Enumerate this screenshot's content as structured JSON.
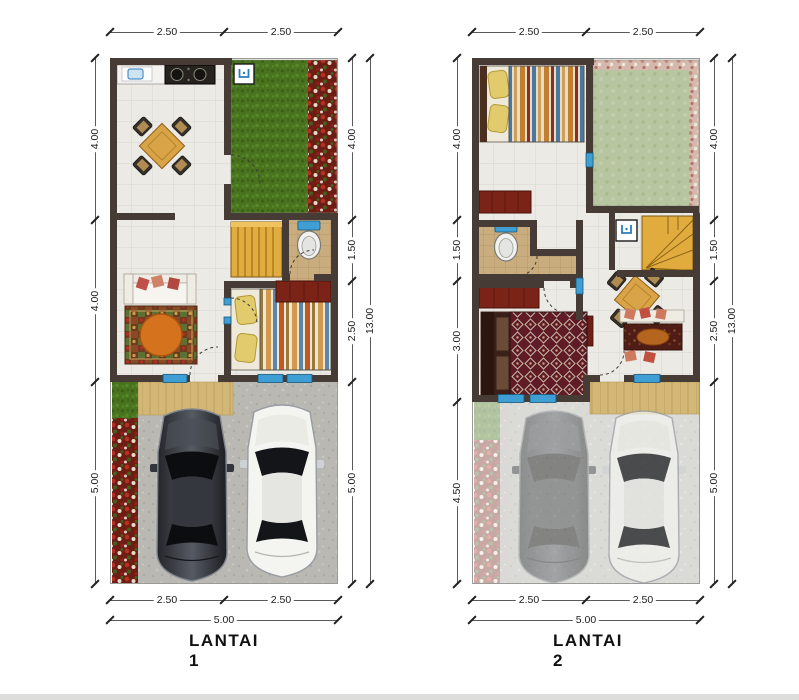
{
  "plans": [
    {
      "label": "LANTAI 1",
      "dims": {
        "top": [
          "2.50",
          "2.50"
        ],
        "bottom": [
          "2.50",
          "2.50"
        ],
        "bottom_total": "5.00",
        "left": [
          "4.00",
          "4.00",
          "5.00"
        ],
        "right": [
          "4.00",
          "1.50",
          "2.50",
          "5.00"
        ],
        "right_total": "13.00"
      }
    },
    {
      "label": "LANTAI 2",
      "dims": {
        "top": [
          "2.50",
          "2.50"
        ],
        "bottom": [
          "2.50",
          "2.50"
        ],
        "bottom_total": "5.00",
        "left": [
          "4.00",
          "1.50",
          "3.00",
          "4.50"
        ],
        "right": [
          "4.00",
          "1.50",
          "2.50",
          "5.00"
        ],
        "right_total": "13.00"
      }
    }
  ],
  "colors": {
    "wall": "#463c35",
    "tile_floor": "#eceae5",
    "bathroom_tile": "#c9ad7e",
    "grass": "#49731f",
    "roof_garden": "#b7c6a0",
    "flower_red": "#6d1d14",
    "stairs_yellow": "#e2ab3e",
    "water_blue": "#3f9fd4",
    "terrace_tan": "#d2b777",
    "furniture_maroon": "#7b2317",
    "concrete": "#b9b8b3"
  },
  "icons": {
    "sink": "sink-icon",
    "stove": "stove-icon",
    "toilet": "toilet-icon",
    "washtub": "washtub-icon",
    "door_swing": "door-arc"
  }
}
